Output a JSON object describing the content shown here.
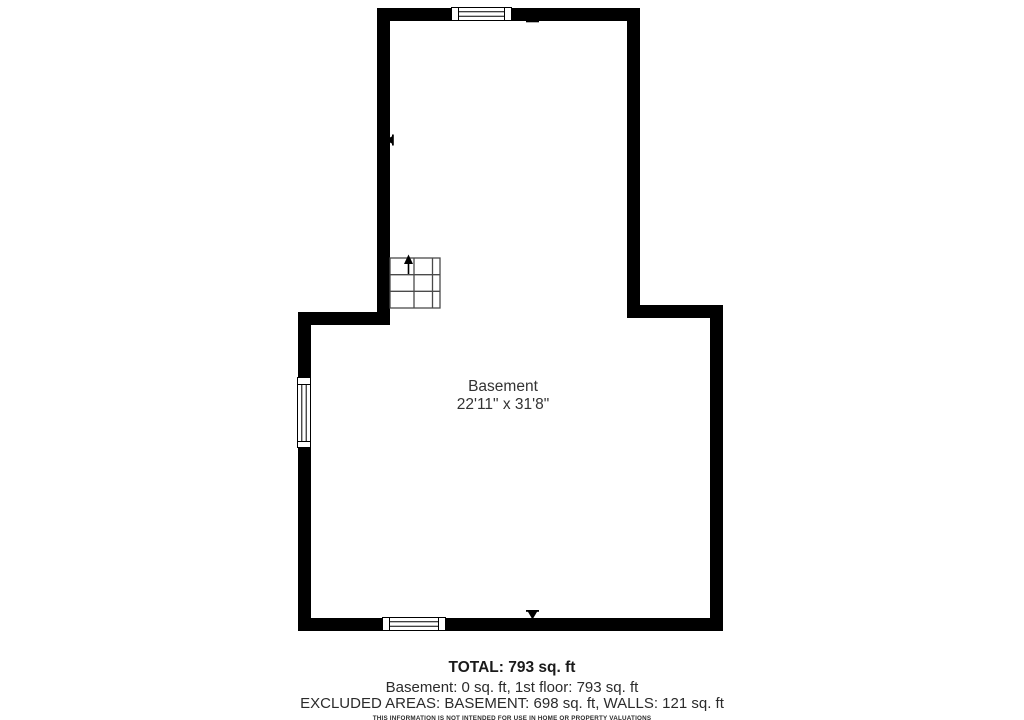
{
  "floorplan": {
    "room": {
      "name": "Basement",
      "dimensions": "22'11\" x 31'8\""
    },
    "features": {
      "stairs": "staircase with up arrow",
      "windows": [
        "top wall window",
        "left wall window",
        "bottom wall window"
      ],
      "door_markers": [
        "top wall marker",
        "left wall marker",
        "bottom wall marker"
      ]
    }
  },
  "summary": {
    "total": "TOTAL: 793 sq. ft",
    "floors": "Basement: 0 sq. ft, 1st floor: 793 sq. ft",
    "excluded": "EXCLUDED AREAS: BASEMENT: 698 sq. ft, WALLS: 121 sq. ft",
    "disclaimer": "THIS INFORMATION IS NOT INTENDED FOR USE IN HOME OR PROPERTY VALUATIONS",
    "disclaimer_small": "When this report is prepared all measurements and calculations are believed accurate only. The drawing is for illustrative purposes only and is not to scale."
  },
  "areas": {
    "total_sq_ft": 793,
    "basement_sq_ft": 0,
    "first_floor_sq_ft": 793,
    "excluded_basement_sq_ft": 698,
    "excluded_walls_sq_ft": 121
  },
  "colors": {
    "wall": "#000000",
    "background": "#ffffff",
    "text": "#333333",
    "stairs_lines": "#4a4a4a"
  }
}
